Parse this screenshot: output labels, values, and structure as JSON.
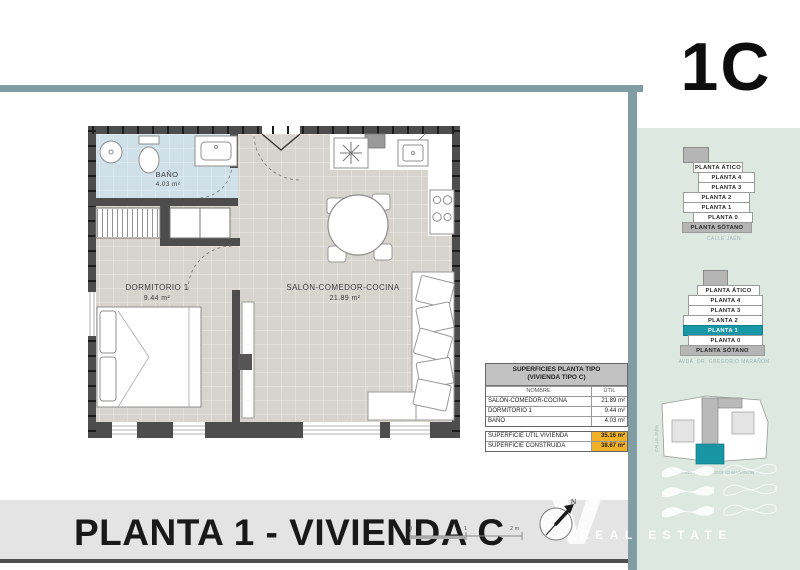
{
  "unit_label": "1C",
  "colors": {
    "frame_teal": "#7f9da3",
    "panel_green": "#dde8e1",
    "highlight_teal": "#1898a6",
    "table_orange": "#f1b127",
    "bath_blue": "#cfe0e9",
    "floor_gray": "#d7d3cd",
    "wall_dark": "#4d4d4d"
  },
  "floor_plan": {
    "rooms": [
      {
        "name": "BAÑO",
        "area": "4.03 m²"
      },
      {
        "name": "DORMITORIO 1",
        "area": "9.44 m²"
      },
      {
        "name": "SALÓN-COMEDOR-COCINA",
        "area": "21.89 m²"
      }
    ]
  },
  "surfaces_table": {
    "title1": "SUPERFICIES PLANTA TIPO",
    "title2": "(VIVIENDA TIPO C)",
    "col_nombre": "NOMBRE",
    "col_util": "ÚTIL",
    "rows": [
      {
        "name": "SALÓN-COMEDOR-COCINA",
        "util": "21.89 m²"
      },
      {
        "name": "DORMITORIO 1",
        "util": "9.44 m²"
      },
      {
        "name": "BAÑO",
        "util": "4.03 m²"
      }
    ],
    "totals": [
      {
        "label": "SUPERFICIE ÚTIL VIVIENDA",
        "value": "35.16 m²"
      },
      {
        "label": "SUPERFICIE CONSTRUIDA",
        "value": "38.67 m²"
      }
    ]
  },
  "sidebar": {
    "stack_top": {
      "floors": [
        "PLANTA ÁTICO",
        "PLANTA 4",
        "PLANTA 3",
        "PLANTA 2",
        "PLANTA 1",
        "PLANTA 0",
        "PLANTA SÓTANO"
      ],
      "street": "CALLE JAÉN"
    },
    "stack_bottom": {
      "floors": [
        "PLANTA ÁTICO",
        "PLANTA 4",
        "PLANTA 3",
        "PLANTA 2",
        "PLANTA 1",
        "PLANTA 0",
        "PLANTA SÓTANO"
      ],
      "highlighted_floor": "PLANTA 1",
      "street": "AVDA. DR. GREGORIO MARAÑÓN"
    },
    "siteplan": {
      "street_left": "CALLE JAÉN",
      "street_bottom": "AVDA. DR. GREGORIO MARAÑÓN"
    }
  },
  "watermark": {
    "brand_v": "V",
    "tagline": "REAL ESTATE"
  },
  "footer": {
    "title": "PLANTA 1 - VIVIENDA C",
    "scale": [
      "0",
      "1",
      "2 m"
    ],
    "north": "N"
  }
}
